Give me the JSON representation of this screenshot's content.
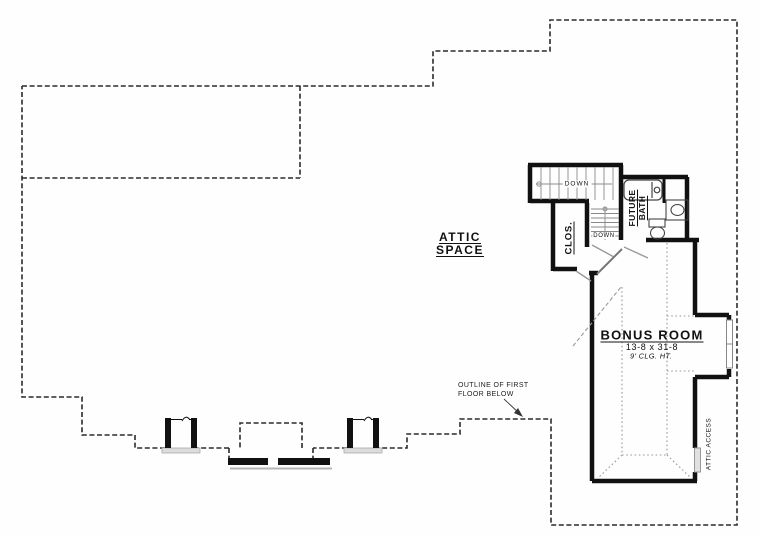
{
  "plan": {
    "title_context": "second floor / attic plan",
    "attic_space": {
      "line1": "ATTIC",
      "line2": "SPACE"
    },
    "bonus_room": {
      "title": "BONUS ROOM",
      "dimensions": "13-8 x 31-8",
      "ceiling": "9' CLG. HT."
    },
    "closet": {
      "label": "CLOS."
    },
    "future_bath": {
      "line1": "FUTURE",
      "line2": "BATH"
    },
    "stairs": {
      "upper_label": "DOWN",
      "lower_label": "DOWN"
    },
    "attic_access": {
      "label": "ATTIC ACCESS"
    },
    "note": {
      "line1": "OUTLINE OF FIRST",
      "line2": "FLOOR BELOW"
    },
    "colors": {
      "wall": "#111111",
      "dashed_outline": "#2b2b2b",
      "fixture": "#444444",
      "tread": "#8a8a8a",
      "door_leaf": "#999999",
      "access_panel": "#e0e0e0",
      "chimney_sill": "#dcdcdc"
    }
  }
}
